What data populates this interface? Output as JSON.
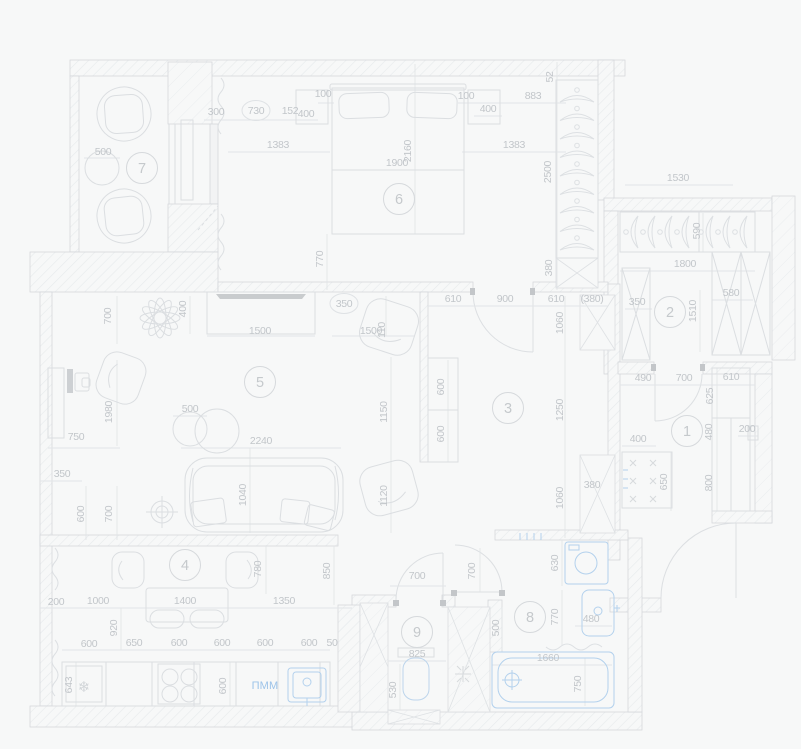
{
  "drawing": {
    "title": "apartment-floor-plan",
    "dishwasher_label": "ПММ",
    "fridge_icon": "❄"
  },
  "colors": {
    "background": "#f7f8f8",
    "wall_line": "#d4d7da",
    "furniture_line": "#dbdee1",
    "light_line": "#e1e4e7",
    "hatch_line": "#e6e9eb",
    "dark_accent": "#c8cbce",
    "blue_fixture": "#b3d1ed",
    "blue_text": "#9cc3e9",
    "dim_text": "#c2c6ca"
  },
  "rooms": [
    {
      "number": "7",
      "x": 142,
      "y": 168
    },
    {
      "number": "6",
      "x": 399,
      "y": 199
    },
    {
      "number": "2",
      "x": 670,
      "y": 312
    },
    {
      "number": "5",
      "x": 260,
      "y": 382
    },
    {
      "number": "3",
      "x": 508,
      "y": 408
    },
    {
      "number": "1",
      "x": 687,
      "y": 431
    },
    {
      "number": "4",
      "x": 185,
      "y": 565
    },
    {
      "number": "9",
      "x": 417,
      "y": 632
    },
    {
      "number": "8",
      "x": 530,
      "y": 617
    }
  ],
  "labels": [
    {
      "t": "500",
      "x": 103,
      "y": 155
    },
    {
      "t": "300",
      "x": 216,
      "y": 115
    },
    {
      "t": "730",
      "x": 256,
      "y": 114,
      "wrap": "circle"
    },
    {
      "t": "152",
      "x": 290,
      "y": 114
    },
    {
      "t": "400",
      "x": 306,
      "y": 117
    },
    {
      "t": "100",
      "x": 323,
      "y": 97
    },
    {
      "t": "1383",
      "x": 278,
      "y": 148
    },
    {
      "t": "100",
      "x": 466,
      "y": 99
    },
    {
      "t": "400",
      "x": 488,
      "y": 112
    },
    {
      "t": "883",
      "x": 533,
      "y": 99
    },
    {
      "t": "52",
      "x": 553,
      "y": 77,
      "r": -90
    },
    {
      "t": "1383",
      "x": 514,
      "y": 148
    },
    {
      "t": "1900",
      "x": 397,
      "y": 166
    },
    {
      "t": "2160",
      "x": 411,
      "y": 151,
      "r": -90
    },
    {
      "t": "2500",
      "x": 551,
      "y": 172,
      "r": -90
    },
    {
      "t": "770",
      "x": 323,
      "y": 259,
      "r": -90
    },
    {
      "t": "380",
      "x": 552,
      "y": 268,
      "r": -90
    },
    {
      "t": "1530",
      "x": 678,
      "y": 181
    },
    {
      "t": "590",
      "x": 700,
      "y": 231,
      "r": -90
    },
    {
      "t": "1800",
      "x": 685,
      "y": 267
    },
    {
      "t": "350",
      "x": 637,
      "y": 305
    },
    {
      "t": "1510",
      "x": 696,
      "y": 311,
      "r": -90
    },
    {
      "t": "580",
      "x": 731,
      "y": 296
    },
    {
      "t": "700",
      "x": 111,
      "y": 316,
      "r": -90
    },
    {
      "t": "400",
      "x": 186,
      "y": 309,
      "r": -90
    },
    {
      "t": "350",
      "x": 344,
      "y": 307,
      "wrap": "circle"
    },
    {
      "t": "1500",
      "x": 260,
      "y": 334
    },
    {
      "t": "1500",
      "x": 371,
      "y": 334
    },
    {
      "t": "110",
      "x": 385,
      "y": 330,
      "r": -90
    },
    {
      "t": "610",
      "x": 453,
      "y": 302
    },
    {
      "t": "900",
      "x": 505,
      "y": 302
    },
    {
      "t": "610",
      "x": 556,
      "y": 302
    },
    {
      "t": "380",
      "x": 592,
      "y": 302,
      "wrap": "parens"
    },
    {
      "t": "1060",
      "x": 563,
      "y": 323,
      "r": -90
    },
    {
      "t": "1980",
      "x": 112,
      "y": 412,
      "r": -90
    },
    {
      "t": "500",
      "x": 190,
      "y": 412
    },
    {
      "t": "600",
      "x": 444,
      "y": 387,
      "r": -90
    },
    {
      "t": "600",
      "x": 444,
      "y": 434,
      "r": -90
    },
    {
      "t": "1150",
      "x": 387,
      "y": 412,
      "r": -90
    },
    {
      "t": "1250",
      "x": 563,
      "y": 410,
      "r": -90
    },
    {
      "t": "750",
      "x": 76,
      "y": 440
    },
    {
      "t": "350",
      "x": 62,
      "y": 477
    },
    {
      "t": "2240",
      "x": 261,
      "y": 444
    },
    {
      "t": "1040",
      "x": 246,
      "y": 495,
      "r": -90
    },
    {
      "t": "600",
      "x": 84,
      "y": 514,
      "r": -90
    },
    {
      "t": "700",
      "x": 112,
      "y": 514,
      "r": -90
    },
    {
      "t": "1120",
      "x": 387,
      "y": 496,
      "r": -90
    },
    {
      "t": "1060",
      "x": 563,
      "y": 498,
      "r": -90
    },
    {
      "t": "380",
      "x": 592,
      "y": 488
    },
    {
      "t": "490",
      "x": 643,
      "y": 381
    },
    {
      "t": "700",
      "x": 684,
      "y": 381
    },
    {
      "t": "610",
      "x": 731,
      "y": 380
    },
    {
      "t": "625",
      "x": 713,
      "y": 396,
      "r": -90
    },
    {
      "t": "480",
      "x": 712,
      "y": 432,
      "r": -90
    },
    {
      "t": "200",
      "x": 747,
      "y": 432
    },
    {
      "t": "800",
      "x": 712,
      "y": 483,
      "r": -90
    },
    {
      "t": "400",
      "x": 638,
      "y": 442
    },
    {
      "t": "650",
      "x": 667,
      "y": 482,
      "r": -90
    },
    {
      "t": "780",
      "x": 261,
      "y": 569,
      "r": -90
    },
    {
      "t": "850",
      "x": 330,
      "y": 571,
      "r": -90
    },
    {
      "t": "200",
      "x": 56,
      "y": 605
    },
    {
      "t": "1000",
      "x": 98,
      "y": 604
    },
    {
      "t": "1400",
      "x": 185,
      "y": 604
    },
    {
      "t": "1350",
      "x": 284,
      "y": 604
    },
    {
      "t": "920",
      "x": 117,
      "y": 628,
      "r": -90
    },
    {
      "t": "600",
      "x": 89,
      "y": 647
    },
    {
      "t": "650",
      "x": 134,
      "y": 646
    },
    {
      "t": "600",
      "x": 179,
      "y": 646
    },
    {
      "t": "600",
      "x": 222,
      "y": 646
    },
    {
      "t": "600",
      "x": 265,
      "y": 646
    },
    {
      "t": "600",
      "x": 309,
      "y": 646
    },
    {
      "t": "50",
      "x": 332,
      "y": 646
    },
    {
      "t": "643",
      "x": 72,
      "y": 685,
      "r": -90
    },
    {
      "t": "600",
      "x": 226,
      "y": 686,
      "r": -90
    },
    {
      "t": "700",
      "x": 417,
      "y": 579
    },
    {
      "t": "700",
      "x": 475,
      "y": 571,
      "r": -90
    },
    {
      "t": "825",
      "x": 417,
      "y": 657
    },
    {
      "t": "530",
      "x": 396,
      "y": 690,
      "r": -90
    },
    {
      "t": "500",
      "x": 499,
      "y": 628,
      "r": -90
    },
    {
      "t": "630",
      "x": 558,
      "y": 563,
      "r": -90
    },
    {
      "t": "770",
      "x": 558,
      "y": 617,
      "r": -90
    },
    {
      "t": "480",
      "x": 591,
      "y": 622
    },
    {
      "t": "1660",
      "x": 548,
      "y": 661
    },
    {
      "t": "750",
      "x": 581,
      "y": 684,
      "r": -90
    },
    {
      "t": "ПММ",
      "x": 265,
      "y": 689,
      "cls": "blue"
    },
    {
      "t": "❄",
      "x": 84,
      "y": 692,
      "cls": "icon"
    }
  ]
}
